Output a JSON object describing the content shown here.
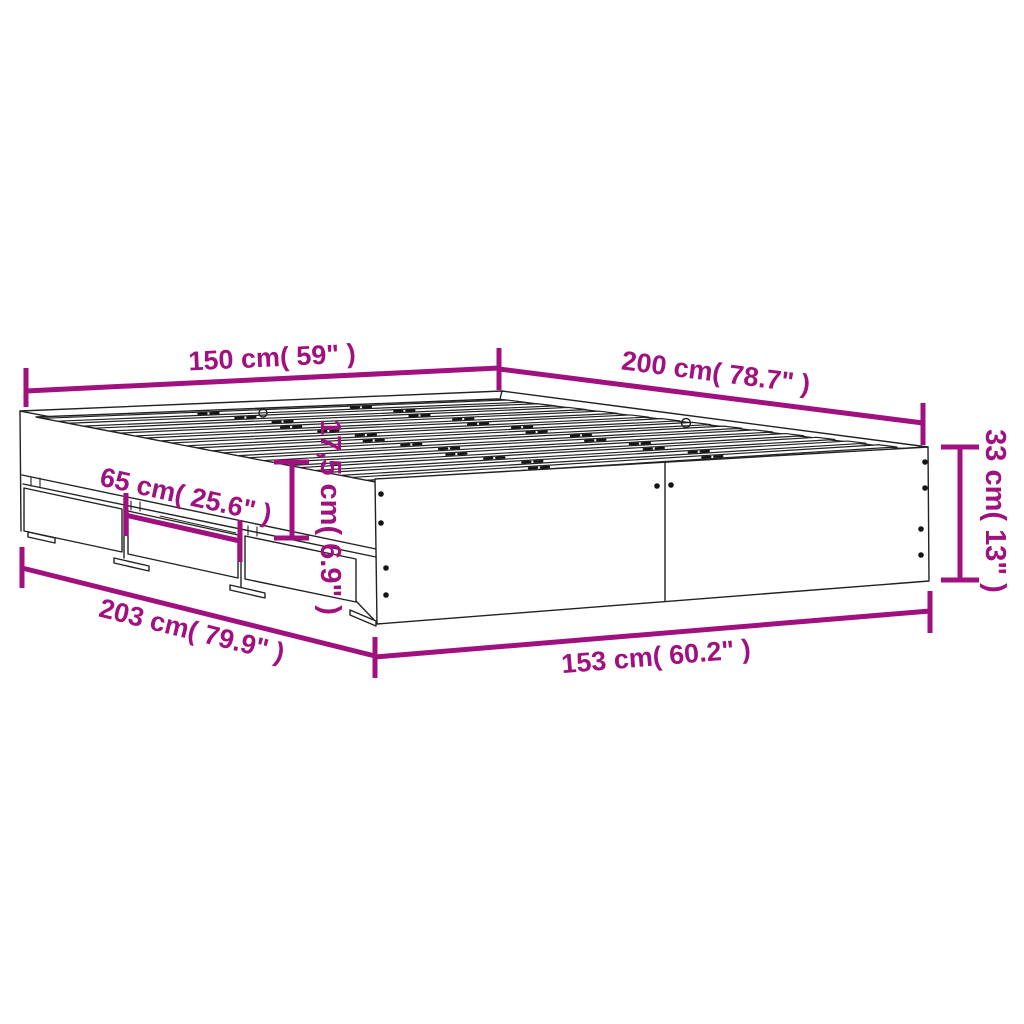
{
  "figure": {
    "kind": "bed-frame-with-drawers-dimension-diagram",
    "slat_count": 13,
    "drawer_count": 3,
    "colors": {
      "dimension": "#A0107E",
      "outline": "#222222",
      "background": "#FFFFFF"
    }
  },
  "dimensions": {
    "top_width": {
      "text": "150 cm( 59\" )"
    },
    "top_length": {
      "text": "200 cm( 78.7\" )"
    },
    "drawer_width": {
      "text": "65 cm( 25.6\" )"
    },
    "drawer_front_height": {
      "text": "17,5 cm( 6.9\" )"
    },
    "frame_height": {
      "text": "33 cm( 13\" )"
    },
    "bottom_length": {
      "text": "203 cm( 79.9\" )"
    },
    "bottom_width": {
      "text": "153 cm( 60.2\" )"
    }
  }
}
